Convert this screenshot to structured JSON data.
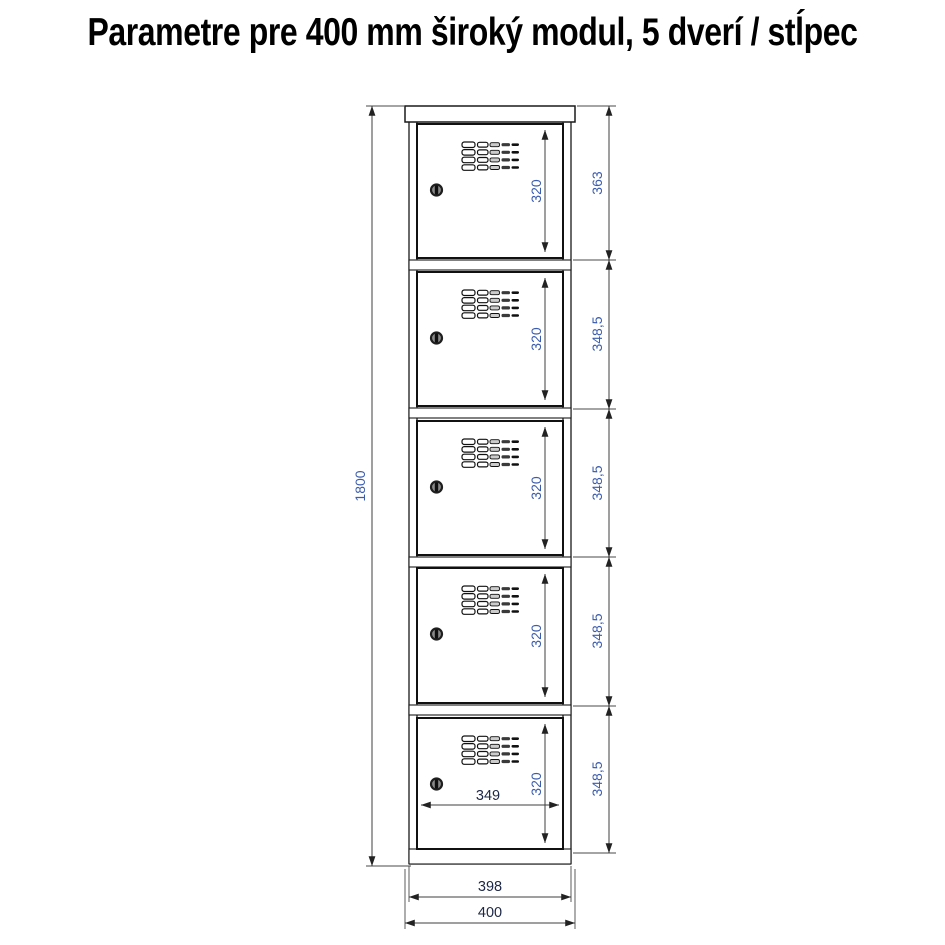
{
  "title": "Parametre pre 400 mm široký modul, 5 dverí / stĺpec",
  "diagram": {
    "overall_height": {
      "label": "1800"
    },
    "right_segments": [
      {
        "label": "363"
      },
      {
        "label": "348,5"
      },
      {
        "label": "348,5"
      },
      {
        "label": "348,5"
      },
      {
        "label": "348,5"
      }
    ],
    "doors": [
      {
        "inner_height": "320"
      },
      {
        "inner_height": "320"
      },
      {
        "inner_height": "320"
      },
      {
        "inner_height": "320"
      },
      {
        "inner_height": "320",
        "inner_width": "349"
      }
    ],
    "bottom_widths": {
      "body": "398",
      "overall": "400"
    },
    "icons": {
      "lock": "lock-icon",
      "vents": "vent-grid-icon"
    },
    "colors": {
      "dim_text_blue": "#3a5cae",
      "dim_text_dark": "#1c2745",
      "cabinet_line": "#1a1a1a",
      "dimension_line": "#3f3f3f",
      "background": "#ffffff"
    }
  }
}
